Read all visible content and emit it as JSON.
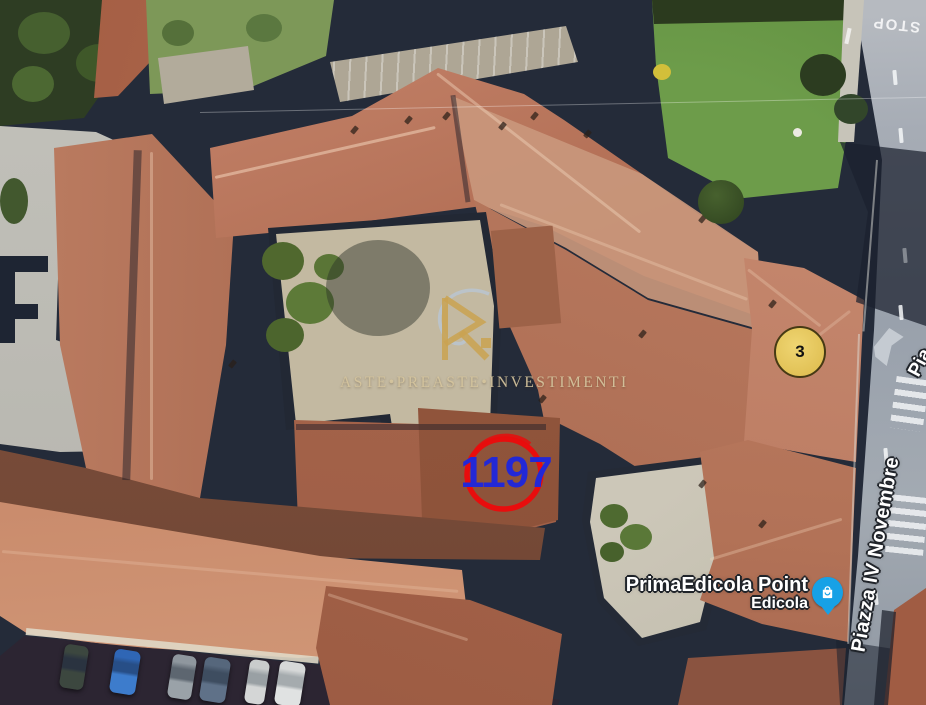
{
  "map": {
    "type": "satellite-aerial-view",
    "watermark": {
      "logo": "aste-preaste-monogram",
      "text": "ASTE•PREASTE•INVESTIMENTI",
      "color": "#c9a352"
    },
    "parcel_annotation": {
      "number": "1197",
      "text_color": "#2328d6",
      "circle_color": "#e80d0d"
    },
    "marker_badge": {
      "label": "3",
      "fill": "#e0c055",
      "border": "#463a14"
    },
    "poi": {
      "name": "PrimaEdicola Point",
      "category": "Edicola",
      "icon": "shopping-bag-icon",
      "pin_color": "#17a1e6"
    },
    "streets": {
      "main": "Piazza IV Novembre",
      "partial": "Pia"
    },
    "road_markings": {
      "stop_text": "STOP"
    }
  }
}
